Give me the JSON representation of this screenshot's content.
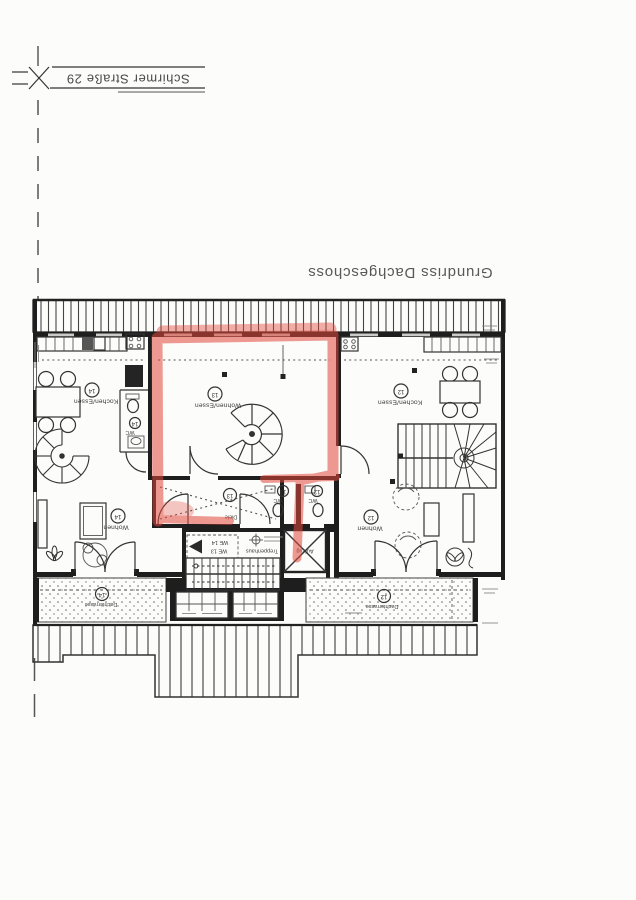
{
  "page": {
    "street_label": "Schirmer Straße 29",
    "title": "Grundriss Dachgeschoss"
  },
  "plan": {
    "highlight_color": "#e2473a",
    "rooms": {
      "kochen14": {
        "name": "Kochen/Essen",
        "number": "14"
      },
      "wohnenessen13": {
        "name": "Wohnen/Essen",
        "number": "13"
      },
      "kochen12": {
        "name": "Kochen/Essen",
        "number": "12"
      },
      "wc14": {
        "name": "WC",
        "number": "14"
      },
      "wohnen14": {
        "name": "Wohnen",
        "number": "14"
      },
      "diele13": {
        "name": "Diele",
        "number": "13"
      },
      "wc13": {
        "name": "WC",
        "number": "13"
      },
      "wc12": {
        "name": "WC",
        "number": "12"
      },
      "wohnen12": {
        "name": "Wohnen",
        "number": "12"
      },
      "terrasse14": {
        "name": "Dachterrasse",
        "number": "14"
      },
      "terrasse12": {
        "name": "Dachterrasse",
        "number": "12"
      }
    },
    "core": {
      "stair_label": "Treppenhaus",
      "elevator_label": "Aufzug",
      "unit_line1": "WE 14",
      "unit_line2": "WE 13"
    }
  }
}
